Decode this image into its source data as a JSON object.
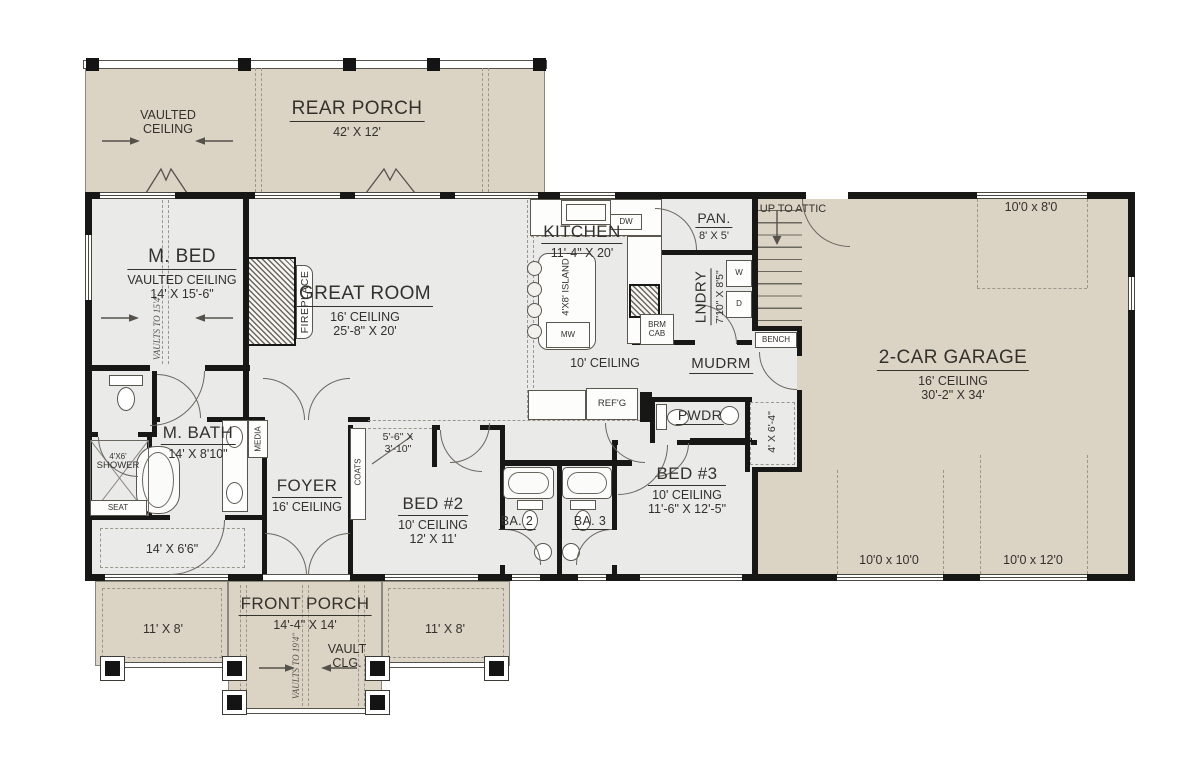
{
  "colors": {
    "porch_fill": "#dbd4c5",
    "interior_fill": "#eaeae8",
    "wall": "#171715",
    "line": "#5a574f",
    "dashed": "#9a968c",
    "text": "#33312c"
  },
  "labels": {
    "vaulted_ceiling_1": "VAULTED",
    "vaulted_ceiling_2": "CEILING",
    "rear_porch": "REAR PORCH",
    "rear_porch_dims": "42' X 12'",
    "m_bed": "M. BED",
    "m_bed_ceiling": "VAULTED CEILING",
    "m_bed_dims": "14' X 15'-6\"",
    "m_bed_vault": "VAULTS TO 15'4\"",
    "fireplace": "FIREPLACE",
    "great_room": "GREAT ROOM",
    "great_room_ceiling": "16' CEILING",
    "great_room_dims": "25'-8\" X 20'",
    "kitchen": "KITCHEN",
    "kitchen_dims": "11'-4\" X 20'",
    "island": "4'X8' ISLAND",
    "mw": "MW",
    "dw": "DW",
    "refg": "REF'G",
    "ceiling_10": "10' CEILING",
    "pantry": "PAN.",
    "pantry_dims": "8' X 5'",
    "laundry": "LNDRY",
    "laundry_dims": "7'10\" X 8'5\"",
    "washer": "W",
    "dryer": "D",
    "brm_cab_1": "BRM",
    "brm_cab_2": "CAB",
    "up_to_attic": "UP TO ATTIC",
    "bench": "BENCH",
    "mudroom": "MUDRM",
    "powder": "PWDR",
    "pwdr_closet_dims": "4' X 6'-4\"",
    "garage": "2-CAR GARAGE",
    "garage_ceiling": "16' CEILING",
    "garage_dims": "30'-2\" X 34'",
    "garage_door_top": "10'0 x 8'0",
    "garage_door_left": "10'0 x 10'0",
    "garage_door_right": "10'0 x 12'0",
    "m_bath": "M. BATH",
    "m_bath_dims": "14' X 8'10\"",
    "shower_1": "4'X6'",
    "shower_2": "SHOWER",
    "seat": "SEAT",
    "media": "MEDIA",
    "coats": "COATS",
    "foyer": "FOYER",
    "foyer_ceiling": "16' CEILING",
    "bed2_closet_1": "5'-6\" X",
    "bed2_closet_2": "3'-10\"",
    "bed2": "BED #2",
    "bed2_ceiling": "10' CEILING",
    "bed2_dims": "12' X 11'",
    "ba2": "BA. 2",
    "ba3": "BA. 3",
    "bed3": "BED #3",
    "bed3_ceiling": "10' CEILING",
    "bed3_dims": "11'-6\" X 12'-5\"",
    "mbed_closet_dims": "14' X 6'6\"",
    "front_porch": "FRONT PORCH",
    "front_porch_dims": "14'-4\" X 14'",
    "porch_left_dims": "11' X 8'",
    "porch_right_dims": "11' X 8'",
    "vault_clg_1": "VAULT",
    "vault_clg_2": "CLG.",
    "front_vault": "VAULTS TO 19'4\""
  }
}
